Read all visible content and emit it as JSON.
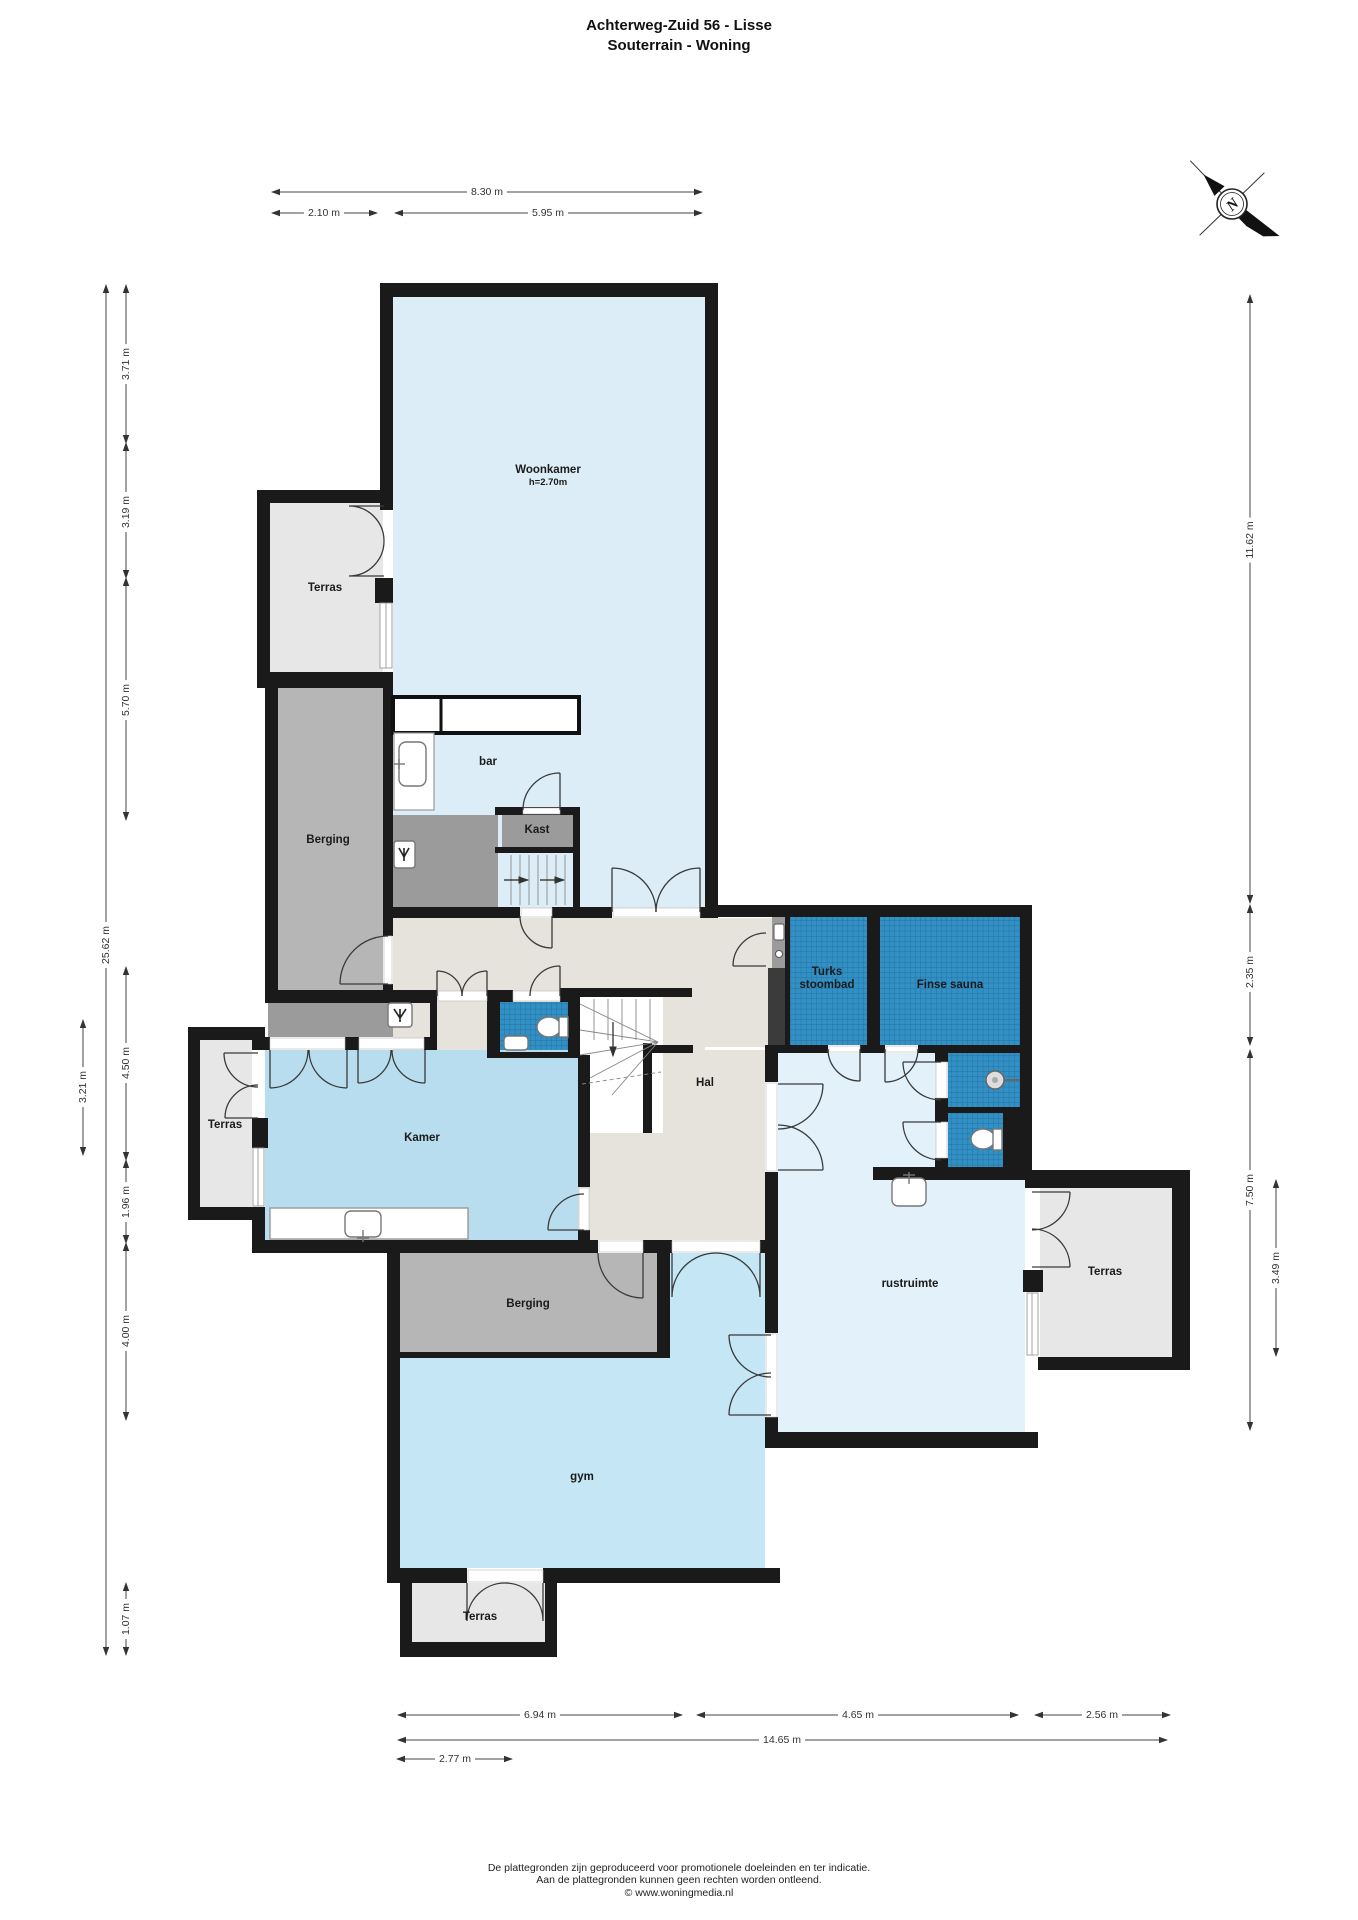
{
  "title": {
    "line1": "Achterweg-Zuid 56 - Lisse",
    "line2": "Souterrain - Woning"
  },
  "compass": {
    "north_label": "N"
  },
  "rooms": {
    "woonkamer": {
      "label": "Woonkamer",
      "note": "h=2.70m"
    },
    "terras_nw": {
      "label": "Terras"
    },
    "berging_boven": {
      "label": "Berging"
    },
    "bar": {
      "label": "bar"
    },
    "kast": {
      "label": "Kast"
    },
    "turks_stoombad": {
      "line1": "Turks",
      "line2": "stoombad"
    },
    "finse_sauna": {
      "label": "Finse sauna"
    },
    "hal": {
      "label": "Hal"
    },
    "kamer": {
      "label": "Kamer"
    },
    "terras_west": {
      "label": "Terras"
    },
    "rustruimte": {
      "label": "rustruimte"
    },
    "terras_oost": {
      "label": "Terras"
    },
    "berging_onder": {
      "label": "Berging"
    },
    "gym": {
      "label": "gym"
    },
    "terras_zuid": {
      "label": "Terras"
    }
  },
  "dims": {
    "top": [
      "8.30 m",
      "2.10 m",
      "5.95 m"
    ],
    "left": [
      "25.62 m",
      "3.71 m",
      "3.19 m",
      "5.70 m",
      "4.50 m",
      "1.96 m",
      "4.00 m",
      "1.07 m",
      "3.21 m"
    ],
    "right": [
      "11.62 m",
      "2.35 m",
      "7.50 m",
      "3.49 m"
    ],
    "bottom": [
      "6.94 m",
      "4.65 m",
      "2.56 m",
      "14.65 m",
      "2.77 m"
    ]
  },
  "footer": {
    "line1": "De plattegronden zijn geproduceerd voor promotionele doeleinden en ter indicatie.",
    "line2": "Aan de plattegronden kunnen geen rechten worden ontleend.",
    "line3": "© www.woningmedia.nl"
  },
  "colors": {
    "wall": "#1a1a1a",
    "room_blue_light": "#dcedf7",
    "room_blue": "#b7ddef",
    "gym_blue": "#c5e6f4",
    "rust_blue": "#e2f1fa",
    "terras_grey": "#e7e7e7",
    "berging_grey": "#b6b6b6",
    "dark_grey": "#9b9b9b",
    "hal_beige": "#e6e3dd",
    "tile_blue": "#3390c4"
  }
}
